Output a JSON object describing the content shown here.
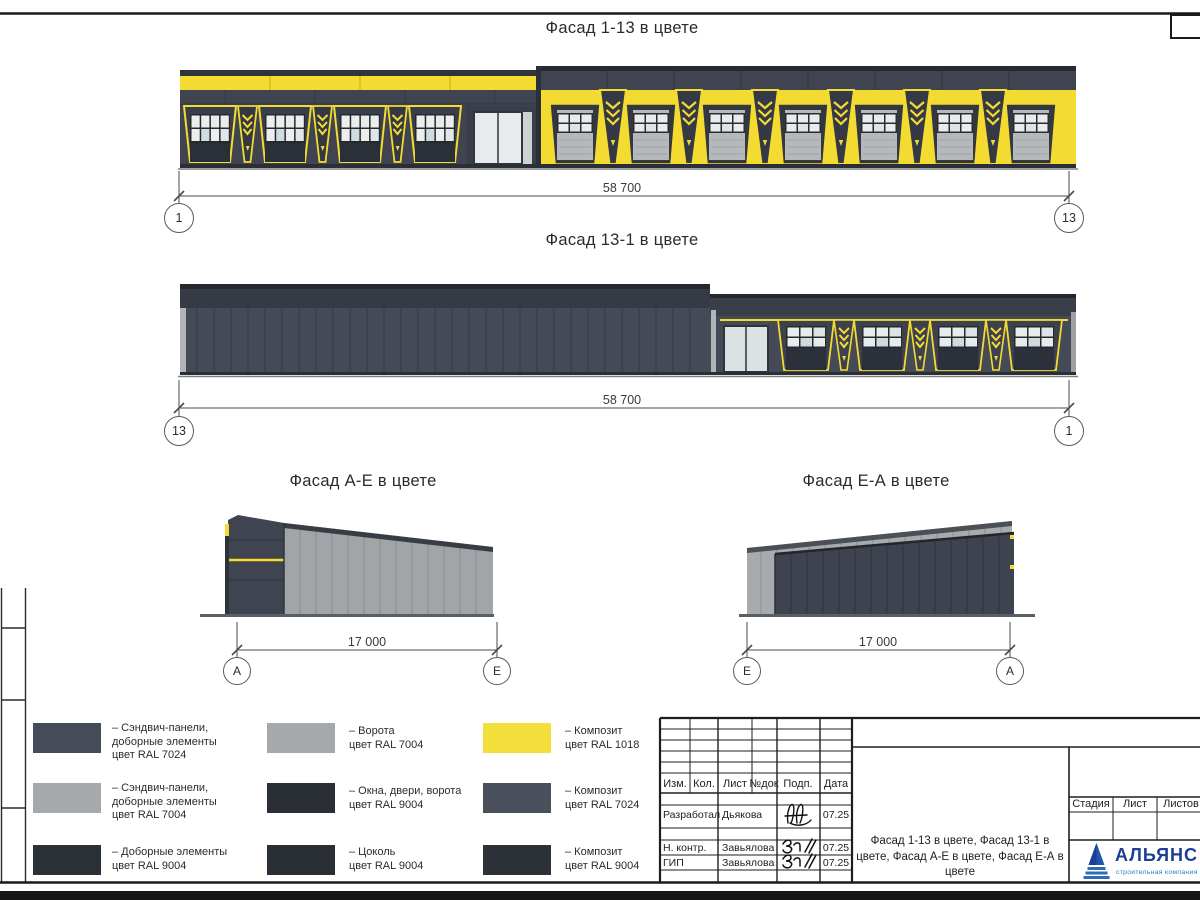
{
  "titles": {
    "f1": "Фасад 1-13 в цвете",
    "f2": "Фасад 13-1 в цвете",
    "f3": "Фасад А-Е в цвете",
    "f4": "Фасад Е-А в цвете"
  },
  "dims": {
    "f1": {
      "len": "58 700",
      "left": "1",
      "right": "13"
    },
    "f2": {
      "len": "58 700",
      "left": "13",
      "right": "1"
    },
    "f3": {
      "len": "17 000",
      "left": "А",
      "right": "Е"
    },
    "f4": {
      "len": "17 000",
      "left": "Е",
      "right": "А"
    }
  },
  "legend": {
    "items": [
      {
        "color": "#464b59",
        "label": "– Сэндвич-панели,\nдоборные элементы\nцвет RAL 7024"
      },
      {
        "color": "#a6a9ab",
        "label": "– Сэндвич-панели,\nдоборные элементы\nцвет RAL 7004"
      },
      {
        "color": "#2b2f36",
        "label": "– Доборные элементы\nцвет RAL 9004"
      },
      {
        "color": "#a6a9ab",
        "label": "– Ворота\nцвет RAL 7004"
      },
      {
        "color": "#2a2e35",
        "label": "– Окна, двери, ворота\nцвет RAL 9004"
      },
      {
        "color": "#2a2e35",
        "label": "– Цоколь\nцвет RAL 9004"
      },
      {
        "color": "#f4de3b",
        "label": "– Композит\nцвет RAL 1018"
      },
      {
        "color": "#4a4f5c",
        "label": "– Композит\nцвет RAL 7024"
      },
      {
        "color": "#2c3037",
        "label": "– Композит\nцвет RAL 9004"
      }
    ]
  },
  "titleblock": {
    "header_cols": [
      "Изм.",
      "Кол.",
      "Лист",
      "№док",
      "Подп.",
      "Дата"
    ],
    "rows": [
      {
        "role": "Разработал",
        "name": "Дьякова",
        "date": "07.25"
      },
      {
        "role": "Н. контр.",
        "name": "Завьялова",
        "date": "07.25"
      },
      {
        "role": "ГИП",
        "name": "Завьялова",
        "date": "07.25"
      }
    ],
    "doc_title": "Фасад 1-13 в цвете, Фасад 13-1 в цвете, Фасад А-Е в цвете, Фасад Е-А в цвете",
    "stage_cols": [
      "Стадия",
      "Лист",
      "Листов"
    ],
    "logo": {
      "name": "АЛЬЯНС",
      "subtitle": "строительная компания"
    }
  }
}
